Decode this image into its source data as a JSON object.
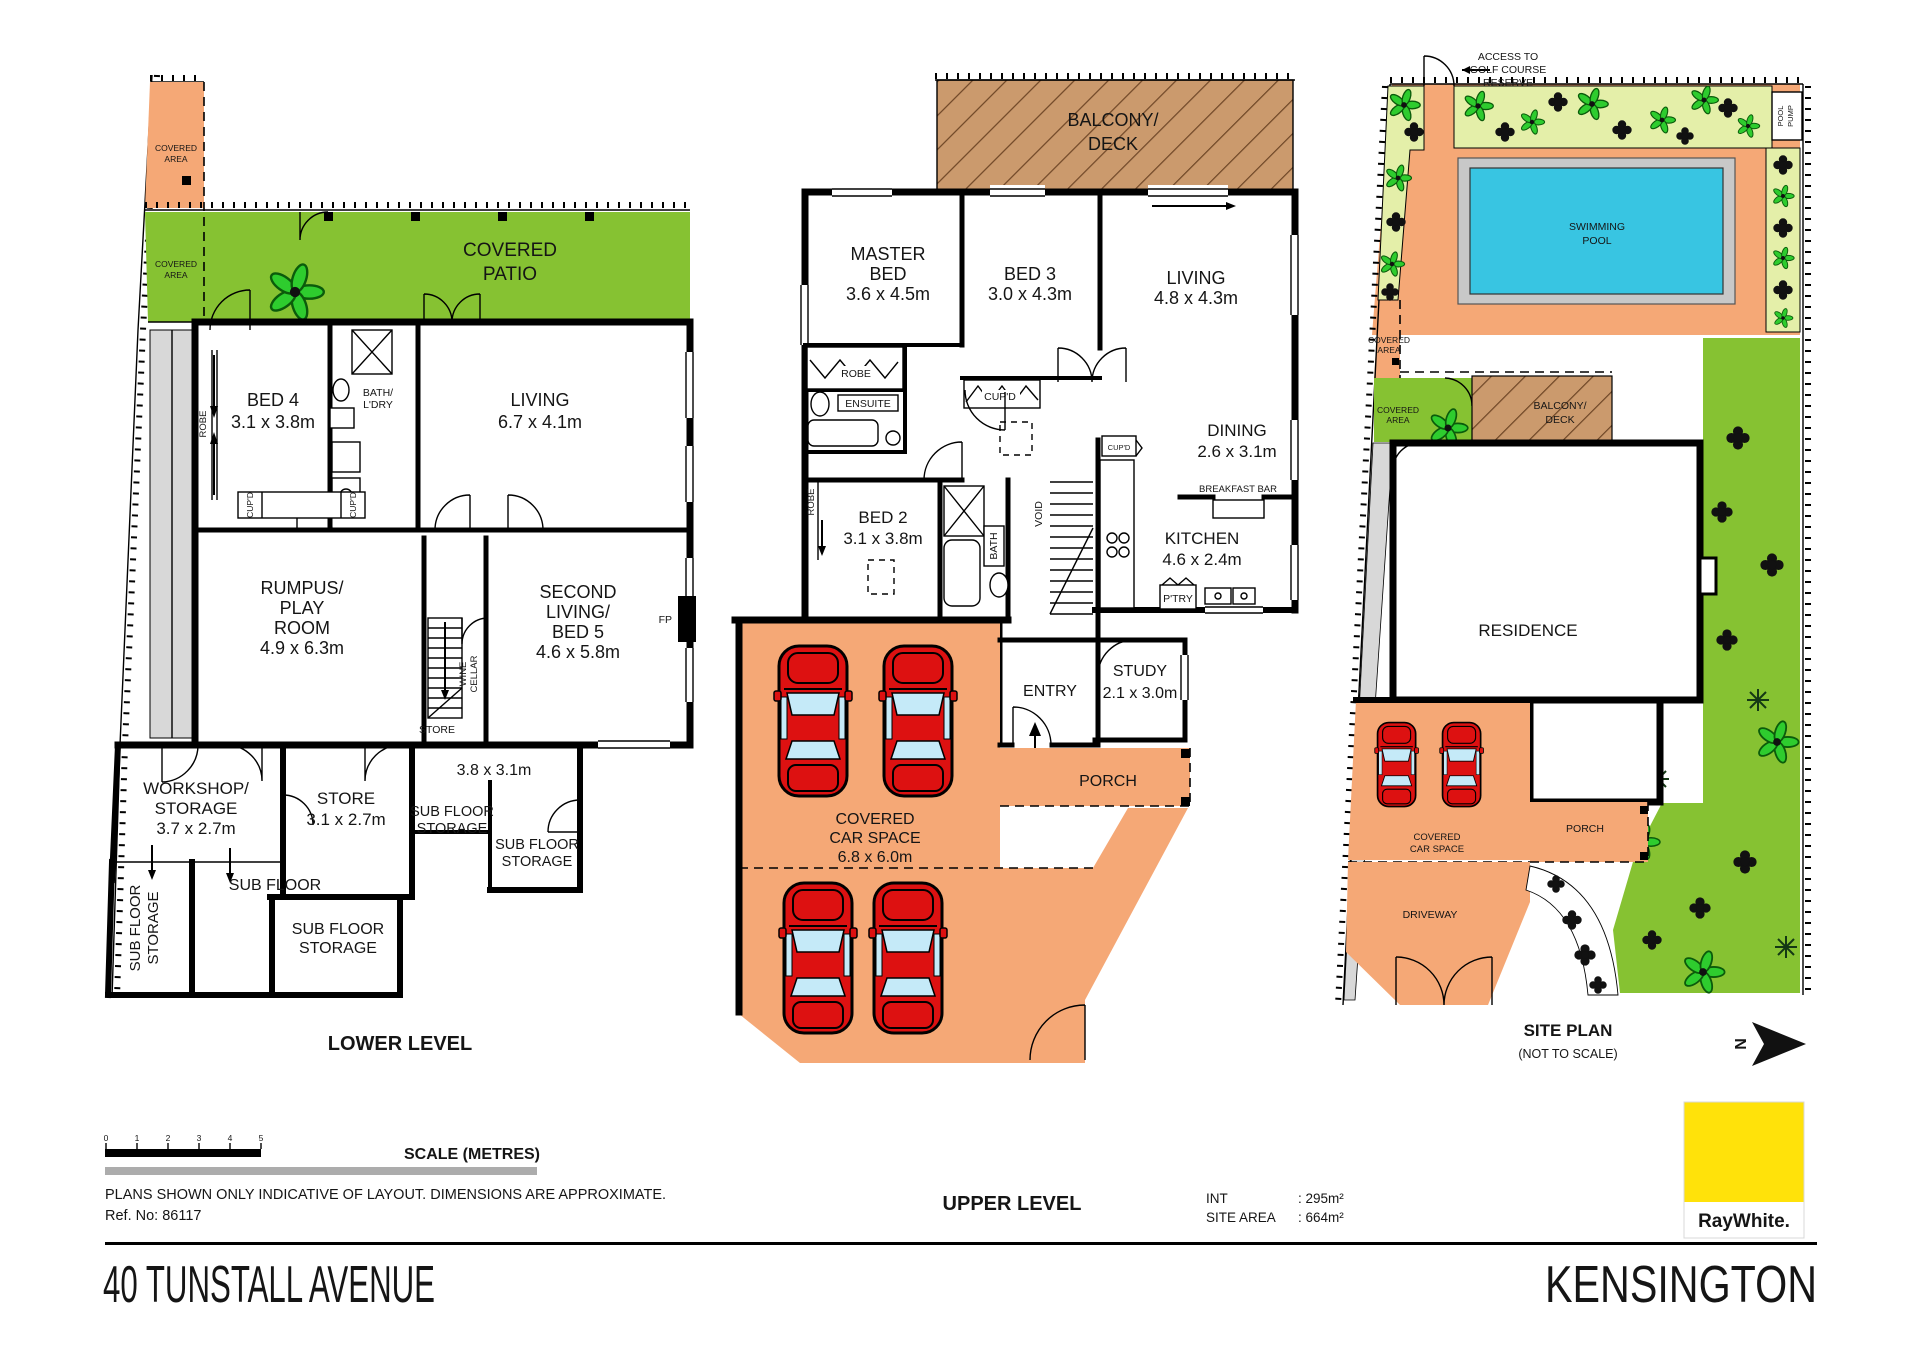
{
  "colors": {
    "paved_orange": "#F5A876",
    "patio_green": "#86C232",
    "garden_light_green": "#E4EFA9",
    "deck_brown": "#CB9A6D",
    "pool_cyan": "#38C5E2",
    "car_red": "#DD1111",
    "brand_yellow": "#FFE20A",
    "wall_black": "#000000"
  },
  "lower": {
    "title": "LOWER LEVEL",
    "covered_area": [
      "COVERED",
      "AREA"
    ],
    "covered_patio": [
      "COVERED",
      "PATIO"
    ],
    "bed4": [
      "BED 4",
      "3.1 x 3.8m"
    ],
    "robe": "ROBE",
    "bath": [
      "BATH/",
      "L'DRY"
    ],
    "living": [
      "LIVING",
      "6.7 x 4.1m"
    ],
    "cupd": "CUP'D",
    "rumpus": [
      "RUMPUS/",
      "PLAY",
      "ROOM",
      "4.9 x 6.3m"
    ],
    "second_living": [
      "SECOND",
      "LIVING/",
      "BED 5",
      "4.6 x 5.8m"
    ],
    "fp": "FP",
    "wine": [
      "WINE",
      "CELLAR"
    ],
    "store_small": "STORE",
    "workshop": [
      "WORKSHOP/",
      "STORAGE",
      "3.7 x 2.7m"
    ],
    "store": [
      "STORE",
      "3.1 x 2.7m"
    ],
    "dim38": "3.8 x 3.1m",
    "subfloor": "SUB FLOOR",
    "subfloor_storage": [
      "SUB FLOOR",
      "STORAGE"
    ]
  },
  "upper": {
    "title": "UPPER LEVEL",
    "balcony": [
      "BALCONY/",
      "DECK"
    ],
    "master": [
      "MASTER",
      "BED",
      "3.6 x 4.5m"
    ],
    "bed3": [
      "BED 3",
      "3.0 x 4.3m"
    ],
    "living": [
      "LIVING",
      "4.8 x 4.3m"
    ],
    "robe": "ROBE",
    "ensuite": "ENSUITE",
    "cupd": "CUP'D",
    "bed2": [
      "BED 2",
      "3.1 x 3.8m"
    ],
    "bath": "BATH",
    "void": "VOID",
    "dining": [
      "DINING",
      "2.6 x 3.1m"
    ],
    "breakfast_bar": "BREAKFAST BAR",
    "kitchen": [
      "KITCHEN",
      "4.6 x 2.4m"
    ],
    "ptry": "P'TRY",
    "study": [
      "STUDY",
      "2.1 x 3.0m"
    ],
    "entry": "ENTRY",
    "porch": "PORCH",
    "car_space": [
      "COVERED",
      "CAR SPACE",
      "6.8 x 6.0m"
    ]
  },
  "site": {
    "title": "SITE PLAN",
    "not_to_scale": "(NOT TO SCALE)",
    "access": [
      "ACCESS TO",
      "GOLF COURSE",
      "RESERVE"
    ],
    "pool_pump": [
      "POOL",
      "PUMP"
    ],
    "pool": [
      "SWIMMING",
      "POOL"
    ],
    "covered_area": [
      "COVERED",
      "AREA"
    ],
    "balcony": [
      "BALCONY/",
      "DECK"
    ],
    "residence": "RESIDENCE",
    "car_space": [
      "COVERED",
      "CAR SPACE"
    ],
    "porch": "PORCH",
    "driveway": "DRIVEWAY",
    "north": "N"
  },
  "footer": {
    "scale_title": "SCALE (METRES)",
    "scale_ticks": [
      "0",
      "1",
      "2",
      "3",
      "4",
      "5"
    ],
    "disclaimer": "PLANS SHOWN ONLY INDICATIVE OF LAYOUT.  DIMENSIONS ARE APPROXIMATE.",
    "ref": "Ref. No: 86117",
    "int_label": "INT",
    "int_value": ": 295m²",
    "site_label": "SITE AREA",
    "site_value": ": 664m²",
    "brand": "RayWhite.",
    "address": "40 TUNSTALL AVENUE",
    "suburb": "KENSINGTON"
  }
}
